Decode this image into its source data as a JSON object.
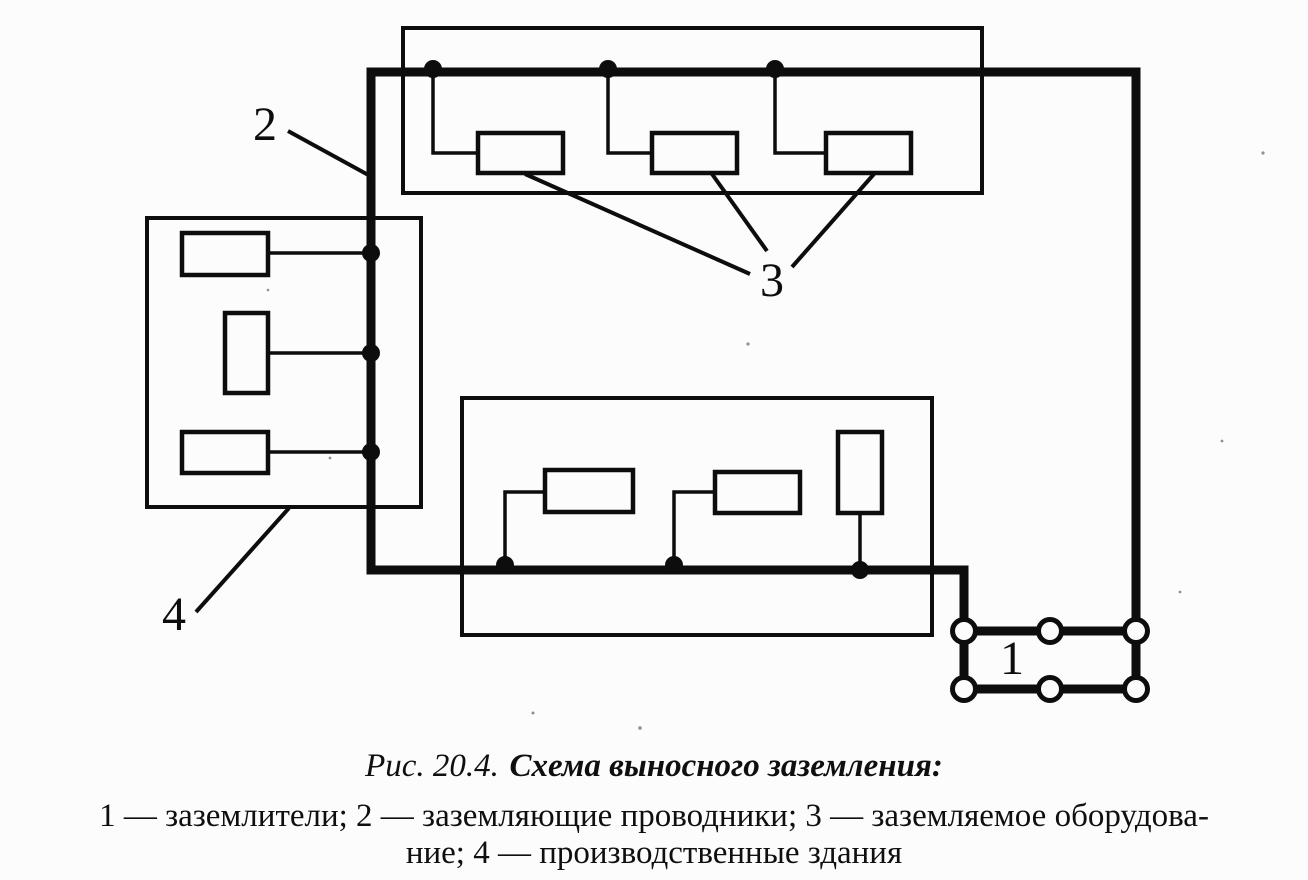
{
  "figure": {
    "caption": {
      "prefix": "Рис. 20.4.",
      "title": "Схема выносного заземления:",
      "legend_line1": "1 — заземлители; 2 — заземляющие проводники; 3 — заземляемое оборудова-",
      "legend_line2": "ние; 4 — производственные здания"
    },
    "callouts": {
      "electrodes": "1",
      "conductors": "2",
      "equipment": "3",
      "buildings": "4"
    },
    "legend_meanings": {
      "1": "заземлители",
      "2": "заземляющие проводники",
      "3": "заземляемое оборудование",
      "4": "производственные здания"
    },
    "structure": {
      "building_count": 3,
      "equipment_box_count": 9,
      "electrode_node_count": 6,
      "bus_junction_dot_count": 9
    },
    "colors": {
      "ink": "#0d0d0d",
      "paper": "#fcfcfc"
    }
  }
}
